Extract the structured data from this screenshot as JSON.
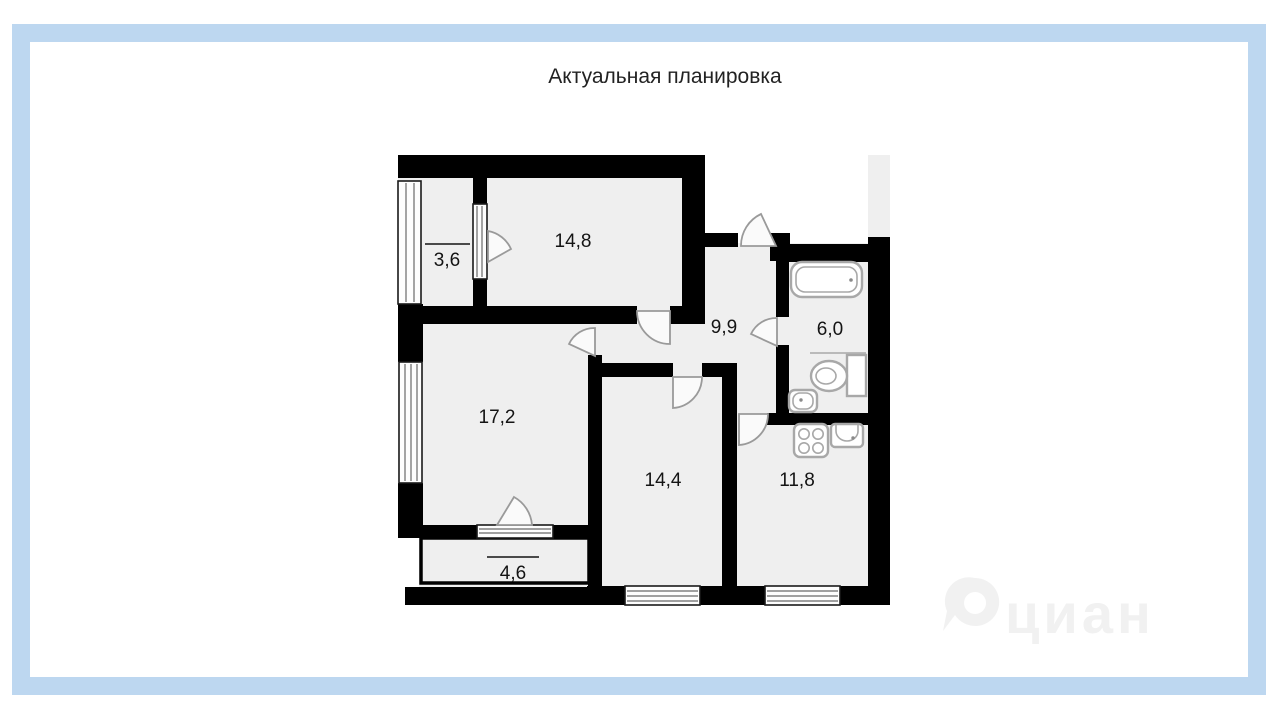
{
  "title": "Актуальная планировка",
  "watermark": {
    "text": "циан"
  },
  "colors": {
    "frame": "#bdd7f0",
    "wall": "#000000",
    "floor": "#efefef",
    "fixture": "#a8a8a8",
    "label": "#141414",
    "watermark": "#f1f1f1"
  },
  "rooms": [
    {
      "area": "3,6",
      "balcony_mark": true
    },
    {
      "area": "14,8",
      "balcony_mark": false
    },
    {
      "area": "9,9",
      "balcony_mark": false
    },
    {
      "area": "6,0",
      "balcony_mark": false
    },
    {
      "area": "17,2",
      "balcony_mark": false
    },
    {
      "area": "14,4",
      "balcony_mark": false
    },
    {
      "area": "11,8",
      "balcony_mark": false
    },
    {
      "area": "4,6",
      "balcony_mark": true
    }
  ],
  "fixtures": [
    "bathtub",
    "toilet",
    "wash-basin",
    "stove",
    "kitchen-sink"
  ]
}
